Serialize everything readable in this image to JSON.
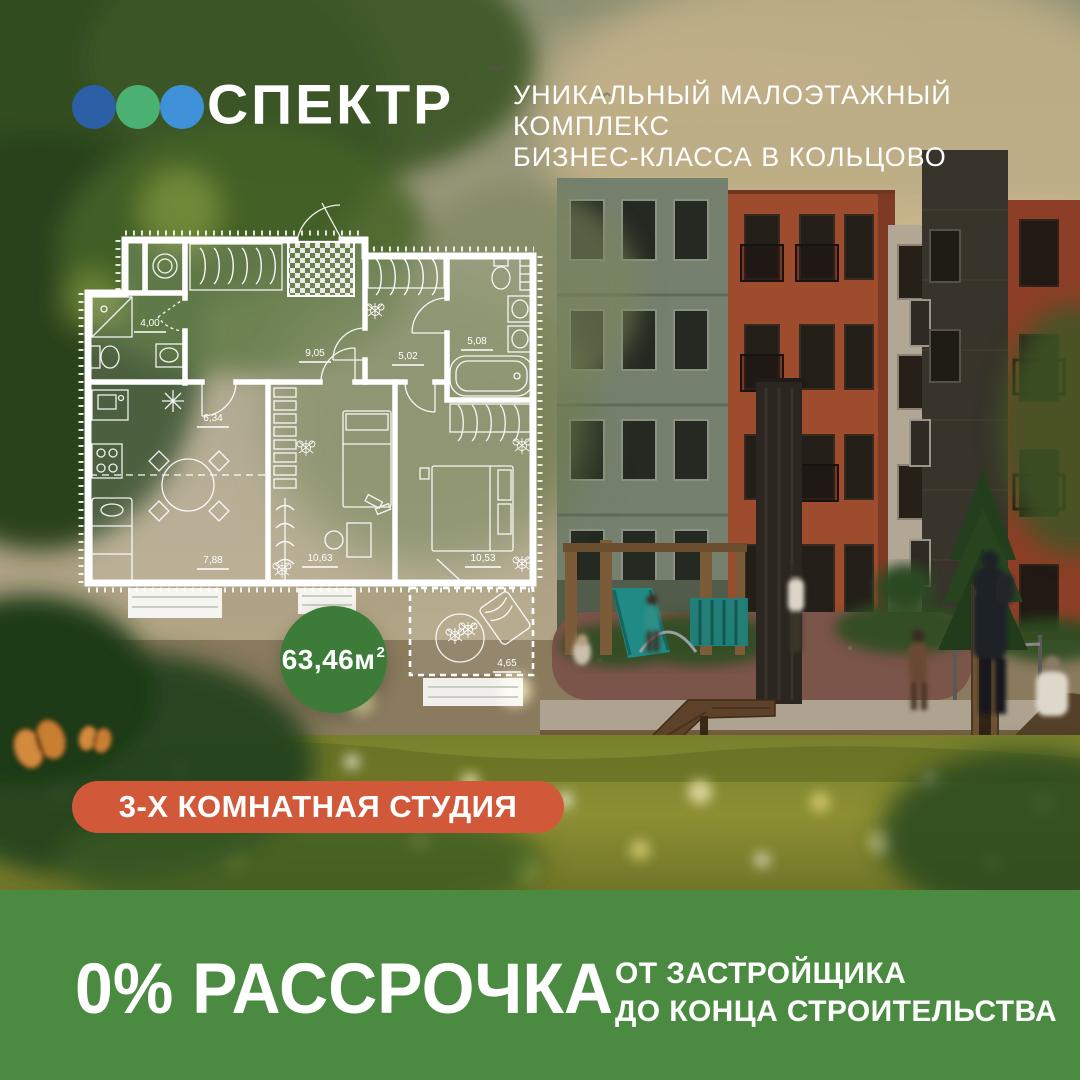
{
  "brand": {
    "logo_text": "СПЕКТР",
    "dots": [
      {
        "name": "dot-navy",
        "color": "#2d5fa6"
      },
      {
        "name": "dot-green",
        "color": "#4bb173"
      },
      {
        "name": "dot-blue",
        "color": "#3f91d8"
      }
    ],
    "tagline_line1": "УНИКАЛЬНЫЙ МАЛОЭТАЖНЫЙ КОМПЛЕКС",
    "tagline_line2": "БИЗНЕС-КЛАССА В КОЛЬЦОВО"
  },
  "floorplan": {
    "total_area": {
      "value": "63,46м",
      "superscript": "2"
    },
    "badge_color": "#3c7c38",
    "rooms": [
      {
        "name": "bathroom",
        "area": "4,00"
      },
      {
        "name": "hall",
        "area": "9,05"
      },
      {
        "name": "dressing-room",
        "area": "5,02"
      },
      {
        "name": "bathroom-2",
        "area": "5,08"
      },
      {
        "name": "kitchen",
        "area": "6,34"
      },
      {
        "name": "living-room",
        "area": "7,88"
      },
      {
        "name": "bedroom-1",
        "area": "10,63"
      },
      {
        "name": "bedroom-2",
        "area": "10,53"
      },
      {
        "name": "balcony",
        "area": "4,65"
      }
    ]
  },
  "apartment_badge": {
    "label": "3-Х КОМНАТНАЯ СТУДИЯ",
    "color": "#d2583a"
  },
  "offer": {
    "headline": "0% РАССРОЧКА",
    "sub_line1": "ОТ ЗАСТРОЙЩИКА",
    "sub_line2": "ДО КОНЦА СТРОИТЕЛЬСТВА",
    "band_color": "#4a8a41"
  }
}
